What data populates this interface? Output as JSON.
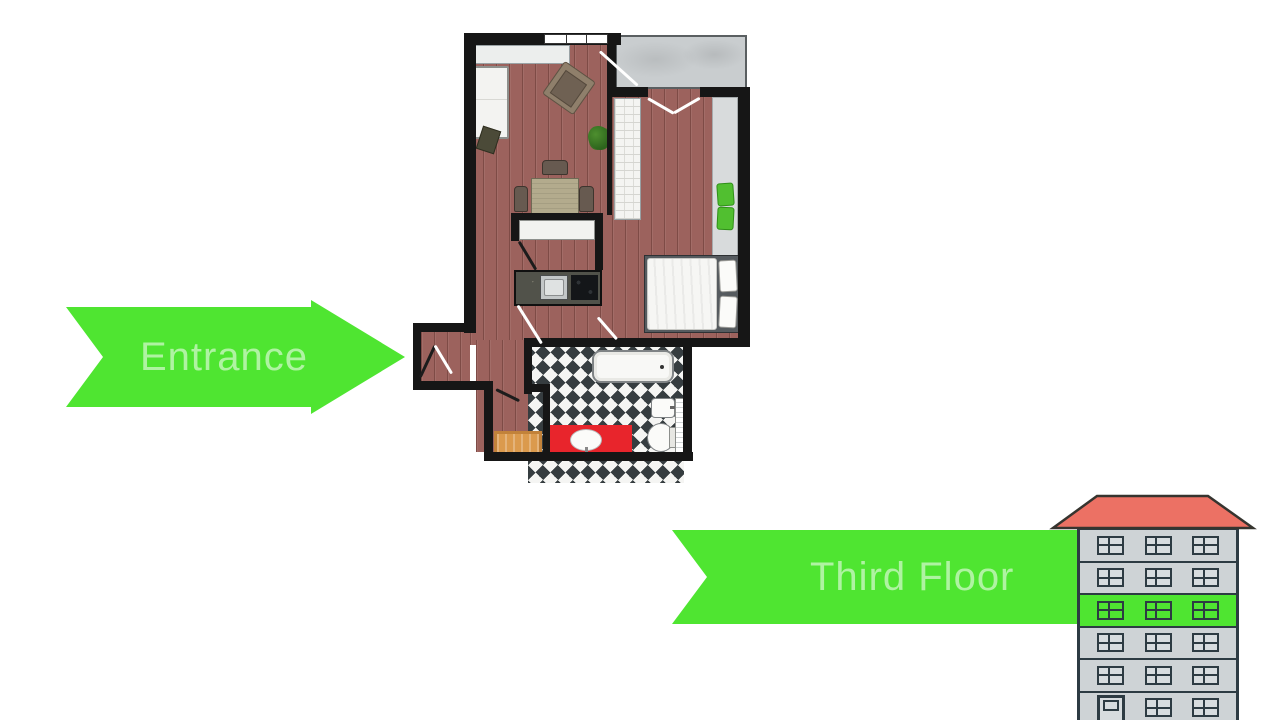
{
  "entrance_arrow": {
    "label": "Entrance"
  },
  "third_floor_arrow": {
    "label": "Third Floor"
  },
  "building": {
    "floors": 6,
    "windows_per_floor": 3,
    "highlighted_floor_from_top": 3,
    "door_floor_from_top": 6
  },
  "palette": {
    "green": "#4fe531",
    "arrow-text": "rgba(255,255,255,0.55)",
    "wood": "#9c625d",
    "wall-black": "#161616",
    "balcony": "#c9cdcf",
    "tile-dark": "#363d40",
    "tile-light": "#f5f5f3",
    "vanity-red": "#e8252c",
    "mat-orange": "#db9a4d",
    "roof": "#ec7164",
    "bwall": "#ced3d6",
    "bframe": "#2d3b43",
    "bpane": "#d7dcdf"
  }
}
